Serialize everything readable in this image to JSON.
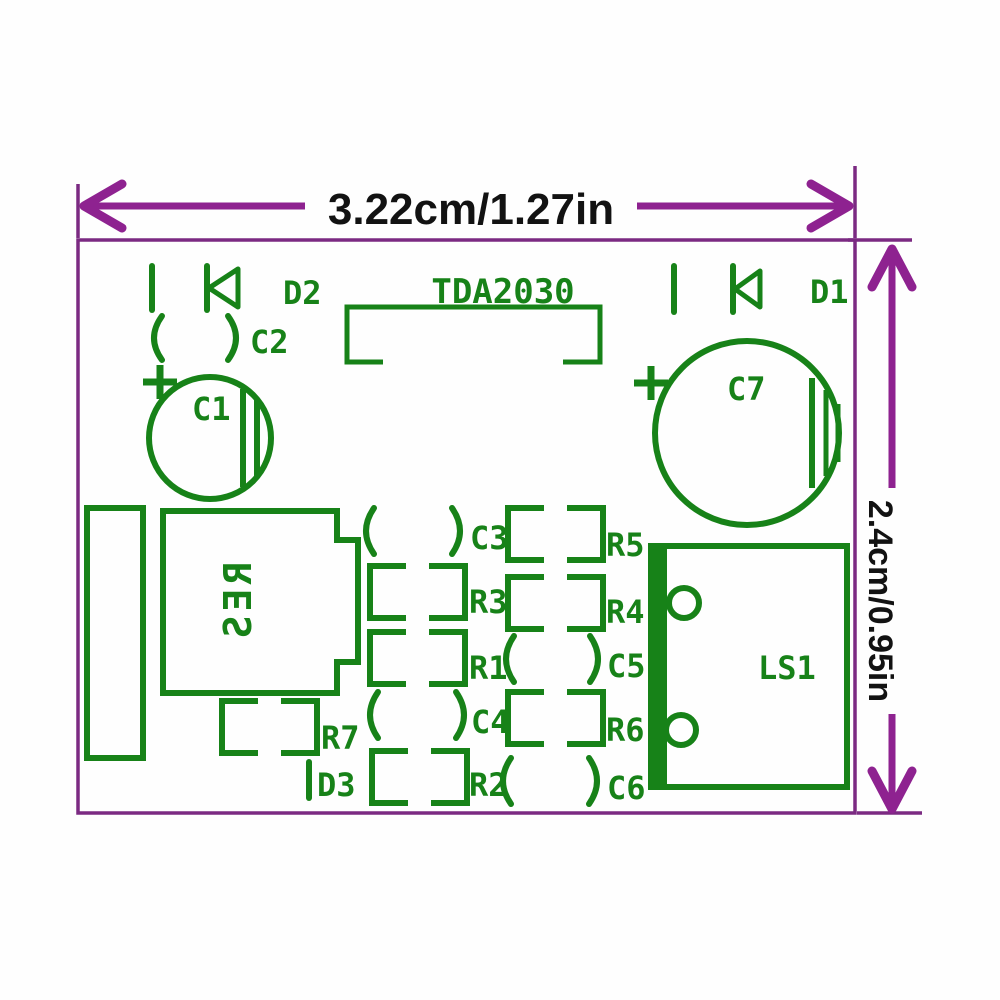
{
  "dimensions": {
    "width_label": "3.22cm/1.27in",
    "height_label": "2.4cm/0.95in"
  },
  "silkscreen": {
    "ic_label": "TDA2030",
    "regulator_label": "RES",
    "speaker_label": "LS1",
    "capacitors": {
      "c1": "C1",
      "c2": "C2",
      "c3": "C3",
      "c4": "C4",
      "c5": "C5",
      "c6": "C6",
      "c7": "C7"
    },
    "resistors": {
      "r1": "R1",
      "r2": "R2",
      "r3": "R3",
      "r4": "R4",
      "r5": "R5",
      "r6": "R6",
      "r7": "R7"
    },
    "diodes": {
      "d1": "D1",
      "d2": "D2",
      "d3": "D3"
    }
  },
  "colors": {
    "silkscreen_green": "#178218",
    "dimension_purple": "#8e2290",
    "board_outline_purple": "#7b2a82",
    "dimension_text_black": "#121212",
    "background": "#fefefe"
  }
}
